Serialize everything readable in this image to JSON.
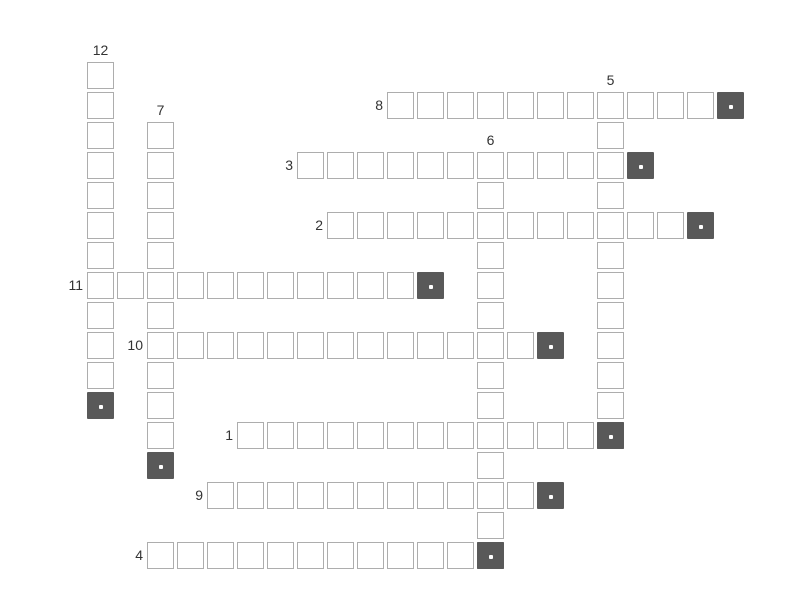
{
  "app": {
    "type": "crossword-puzzle-board"
  },
  "board": {
    "background": "#ffffff",
    "grid": {
      "origin_x": 87,
      "origin_y": 62,
      "pitch": 30,
      "cell_size": 27
    },
    "cell_style": {
      "fill": "#ffffff",
      "border_color": "#adadad"
    },
    "end_marker_style": {
      "fill": "#595959",
      "dot_color": "#ffffff"
    },
    "clue_number_color": "#333333",
    "words": [
      {
        "number": "1",
        "direction": "across",
        "col": 5,
        "row": 12,
        "length": 12,
        "has_end_marker": true
      },
      {
        "number": "2",
        "direction": "across",
        "col": 8,
        "row": 5,
        "length": 12,
        "has_end_marker": true
      },
      {
        "number": "3",
        "direction": "across",
        "col": 7,
        "row": 3,
        "length": 11,
        "has_end_marker": true
      },
      {
        "number": "4",
        "direction": "across",
        "col": 2,
        "row": 16,
        "length": 11,
        "has_end_marker": true
      },
      {
        "number": "5",
        "direction": "down",
        "col": 17,
        "row": 1,
        "length": 11,
        "has_end_marker": true
      },
      {
        "number": "6",
        "direction": "down",
        "col": 13,
        "row": 3,
        "length": 13,
        "has_end_marker": true
      },
      {
        "number": "7",
        "direction": "down",
        "col": 2,
        "row": 2,
        "length": 11,
        "has_end_marker": true
      },
      {
        "number": "8",
        "direction": "across",
        "col": 10,
        "row": 1,
        "length": 11,
        "has_end_marker": true
      },
      {
        "number": "9",
        "direction": "across",
        "col": 4,
        "row": 14,
        "length": 11,
        "has_end_marker": true
      },
      {
        "number": "10",
        "direction": "across",
        "col": 2,
        "row": 9,
        "length": 13,
        "has_end_marker": true
      },
      {
        "number": "11",
        "direction": "across",
        "col": 0,
        "row": 7,
        "length": 11,
        "has_end_marker": true
      },
      {
        "number": "12",
        "direction": "down",
        "col": 0,
        "row": 0,
        "length": 11,
        "has_end_marker": true
      }
    ]
  }
}
